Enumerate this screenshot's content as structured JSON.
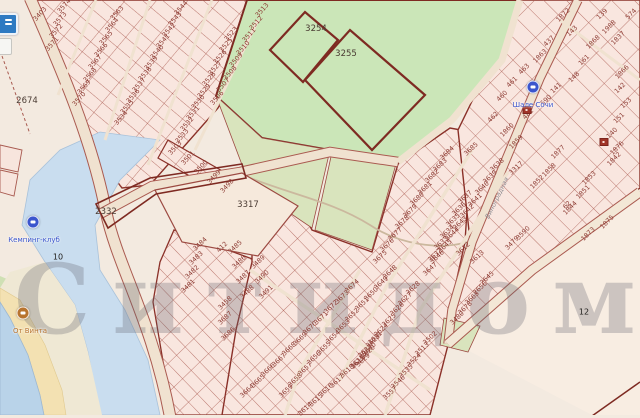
{
  "watermark": {
    "text": "Ситидом"
  },
  "street": {
    "name": "Виноградная",
    "x": 497,
    "y": 198,
    "rot": -64
  },
  "controls": {
    "buttons": [
      {
        "name": "map-layers-button",
        "color": "#2e7ac2"
      },
      {
        "name": "map-control-button",
        "color": "#f6f6f3"
      }
    ]
  },
  "pois": [
    {
      "kind": "lodging",
      "x": 533,
      "y": 87,
      "label": "Шале Сочи",
      "lx": 533,
      "ly": 96,
      "color": "#3b55cd"
    },
    {
      "kind": "club",
      "x": 33,
      "y": 222,
      "label": "Кемпинг-клуб",
      "lx": 34,
      "ly": 231,
      "color": "#3b55cd"
    },
    {
      "kind": "cafe",
      "x": 23,
      "y": 313,
      "label": "От Винта",
      "lx": 30,
      "ly": 322,
      "color": "#b8742f"
    }
  ],
  "buildings": [
    {
      "x": 604,
      "y": 142
    },
    {
      "x": 527,
      "y": 110
    }
  ],
  "area_labels": [
    {
      "t": "2674",
      "x": 27,
      "y": 101
    },
    {
      "t": "2332",
      "x": 106,
      "y": 212
    },
    {
      "t": "3317",
      "x": 248,
      "y": 205
    },
    {
      "t": "3254",
      "x": 316,
      "y": 29
    },
    {
      "t": "3255",
      "x": 346,
      "y": 54
    }
  ],
  "small_labels": [
    {
      "t": "10",
      "x": 58,
      "y": 257
    },
    {
      "t": "12",
      "x": 584,
      "y": 312
    }
  ],
  "parcel_blocks": [
    {
      "rot": -48,
      "start": [
        64,
        6
      ],
      "step": [
        -4,
        12.5
      ],
      "nums": [
        "3574",
        "3573",
        "3572",
        "3571"
      ]
    },
    {
      "rot": -48,
      "start": [
        117,
        13
      ],
      "step": [
        -5.5,
        12.3
      ],
      "nums": [
        "3563",
        "3564",
        "3565",
        "3566",
        "3567",
        "3568",
        "3569",
        "3570"
      ]
    },
    {
      "rot": -48,
      "start": [
        181,
        8
      ],
      "step": [
        -6,
        11
      ],
      "nums": [
        "3544",
        "3543",
        "3542",
        "3541",
        "3540",
        "3539",
        "3538",
        "3537",
        "3536",
        "3535",
        "3534"
      ]
    },
    {
      "rot": -48,
      "start": [
        231,
        34
      ],
      "step": [
        -5.5,
        11.3
      ],
      "nums": [
        "3523",
        "3525",
        "3526",
        "3527",
        "3528",
        "3529",
        "3530",
        "3531",
        "3532",
        "3533"
      ]
    },
    {
      "rot": -48,
      "start": [
        262,
        10
      ],
      "step": [
        -6.5,
        12.5
      ],
      "nums": [
        "3513",
        "3512",
        "3511",
        "3510",
        "3509",
        "3508",
        "3507",
        "3506"
      ]
    },
    {
      "rot": -47,
      "start": [
        175,
        148
      ],
      "step": [
        13,
        9.5
      ],
      "nums": [
        "3503",
        "3501",
        "3500",
        "3499",
        "3498"
      ]
    },
    {
      "rot": -44,
      "start": [
        200,
        244
      ],
      "step": [
        -4,
        14
      ],
      "nums": [
        "3484",
        "3483",
        "3482",
        "3481"
      ]
    },
    {
      "rot": -44,
      "start": [
        235,
        247
      ],
      "step": [
        4,
        15
      ],
      "nums": [
        "3485",
        "3486",
        "3487",
        "3488"
      ]
    },
    {
      "rot": -44,
      "start": [
        258,
        262
      ],
      "step": [
        4,
        15
      ],
      "nums": [
        "3489",
        "3490",
        "3491"
      ]
    },
    {
      "rot": -44,
      "start": [
        225,
        318
      ],
      "step": [
        3,
        16
      ],
      "nums": [
        "3687",
        "3686"
      ]
    },
    {
      "rot": -43,
      "start": [
        447,
        153
      ],
      "step": [
        -7.5,
        11.5
      ],
      "nums": [
        "3684",
        "3683",
        "3682",
        "3681",
        "3680",
        "3679",
        "3678",
        "3677",
        "3676",
        "3675"
      ]
    },
    {
      "rot": -43,
      "start": [
        497,
        165
      ],
      "step": [
        -7.5,
        11.5
      ],
      "nums": [
        "3638",
        "3639",
        "3640",
        "3641",
        "3642",
        "3643",
        "3644",
        "3645",
        "3646",
        "3647"
      ]
    },
    {
      "rot": -43,
      "start": [
        352,
        286
      ],
      "step": [
        -10.5,
        10.5
      ],
      "nums": [
        "3674",
        "3673",
        "3672",
        "3671",
        "3670",
        "3669",
        "3668",
        "3667",
        "3666",
        "3665",
        "3664"
      ]
    },
    {
      "rot": -43,
      "start": [
        390,
        272
      ],
      "step": [
        -9.5,
        10.8
      ],
      "nums": [
        "3648",
        "3649",
        "3650",
        "3651",
        "3652",
        "3653",
        "3654",
        "3655",
        "3656",
        "3657",
        "3658",
        "3659"
      ]
    },
    {
      "rot": -43,
      "start": [
        368,
        352
      ],
      "step": [
        -10.5,
        9.5
      ],
      "nums": [
        "3620",
        "3619",
        "3618",
        "3617",
        "3616",
        "3615",
        "3614"
      ]
    },
    {
      "rot": -43,
      "start": [
        430,
        338
      ],
      "step": [
        -8,
        11
      ],
      "nums": [
        "3502",
        "3513",
        "3524",
        "3535",
        "3546",
        "3557"
      ]
    },
    {
      "rot": -43,
      "start": [
        465,
        197
      ],
      "step": [
        -6,
        11.5
      ],
      "nums": [
        "3637",
        "3636",
        "3635",
        "3634",
        "3633",
        "3632"
      ]
    },
    {
      "rot": -43,
      "start": [
        413,
        288
      ],
      "step": [
        -8,
        10.5
      ],
      "nums": [
        "3628",
        "3627",
        "3626",
        "3625",
        "3624",
        "3623",
        "3622",
        "3621"
      ]
    },
    {
      "rot": -43,
      "start": [
        375,
        338
      ],
      "step": [
        -6,
        11
      ],
      "nums": [
        "3631",
        "3630",
        "3629"
      ]
    },
    {
      "rot": -43,
      "start": [
        487,
        278
      ],
      "step": [
        -7.5,
        10
      ],
      "nums": [
        "2645",
        "2656",
        "3663",
        "3678",
        "3480"
      ]
    }
  ],
  "parcel_singles": [
    {
      "t": "3403",
      "x": 40,
      "y": 14,
      "rot": -48
    },
    {
      "t": "412",
      "x": 222,
      "y": 247,
      "rot": -44
    },
    {
      "t": "3458",
      "x": 225,
      "y": 303,
      "rot": -44
    },
    {
      "t": "3685",
      "x": 471,
      "y": 149,
      "rot": -43
    },
    {
      "t": "3317",
      "x": 516,
      "y": 168,
      "rot": -43
    },
    {
      "t": "3612",
      "x": 463,
      "y": 249,
      "rot": -43
    },
    {
      "t": "3613",
      "x": 477,
      "y": 257,
      "rot": -43
    },
    {
      "t": "3590",
      "x": 523,
      "y": 233,
      "rot": -45
    },
    {
      "t": "3479",
      "x": 512,
      "y": 243,
      "rot": -45
    },
    {
      "t": "62",
      "x": 567,
      "y": 205,
      "rot": -45
    },
    {
      "t": "1872",
      "x": 563,
      "y": 15,
      "rot": -45
    },
    {
      "t": "143",
      "x": 572,
      "y": 31,
      "rot": -45
    },
    {
      "t": "139",
      "x": 602,
      "y": 14,
      "rot": -45
    },
    {
      "t": "1988",
      "x": 609,
      "y": 27,
      "rot": -45
    },
    {
      "t": "574",
      "x": 631,
      "y": 14,
      "rot": -45
    },
    {
      "t": "1837",
      "x": 618,
      "y": 38,
      "rot": -45
    },
    {
      "t": "1868",
      "x": 593,
      "y": 42,
      "rot": -45
    },
    {
      "t": "437",
      "x": 549,
      "y": 41,
      "rot": -45
    },
    {
      "t": "1863",
      "x": 540,
      "y": 56,
      "rot": -45
    },
    {
      "t": "161",
      "x": 584,
      "y": 60,
      "rot": -45
    },
    {
      "t": "1866",
      "x": 622,
      "y": 72,
      "rot": -45
    },
    {
      "t": "148",
      "x": 574,
      "y": 77,
      "rot": -45
    },
    {
      "t": "141",
      "x": 556,
      "y": 88,
      "rot": -45
    },
    {
      "t": "142",
      "x": 620,
      "y": 88,
      "rot": -45
    },
    {
      "t": "463",
      "x": 524,
      "y": 69,
      "rot": -45
    },
    {
      "t": "461",
      "x": 512,
      "y": 82,
      "rot": -45
    },
    {
      "t": "460",
      "x": 502,
      "y": 96,
      "rot": -45
    },
    {
      "t": "462",
      "x": 493,
      "y": 117,
      "rot": -45
    },
    {
      "t": "481",
      "x": 528,
      "y": 114,
      "rot": -45
    },
    {
      "t": "590",
      "x": 546,
      "y": 100,
      "rot": -45
    },
    {
      "t": "153",
      "x": 626,
      "y": 103,
      "rot": -45
    },
    {
      "t": "151",
      "x": 619,
      "y": 118,
      "rot": -45
    },
    {
      "t": "140",
      "x": 612,
      "y": 133,
      "rot": -45
    },
    {
      "t": "1860",
      "x": 507,
      "y": 130,
      "rot": -45
    },
    {
      "t": "1859",
      "x": 516,
      "y": 142,
      "rot": -45
    },
    {
      "t": "1877",
      "x": 558,
      "y": 152,
      "rot": -45
    },
    {
      "t": "1858",
      "x": 549,
      "y": 170,
      "rot": -45
    },
    {
      "t": "1852",
      "x": 537,
      "y": 182,
      "rot": -45
    },
    {
      "t": "1853",
      "x": 589,
      "y": 178,
      "rot": -45
    },
    {
      "t": "1851",
      "x": 583,
      "y": 192,
      "rot": -45
    },
    {
      "t": "1842",
      "x": 614,
      "y": 159,
      "rot": -45
    },
    {
      "t": "1844",
      "x": 570,
      "y": 208,
      "rot": -45
    },
    {
      "t": "1875",
      "x": 607,
      "y": 222,
      "rot": -45
    },
    {
      "t": "1873",
      "x": 588,
      "y": 234,
      "rot": -45
    },
    {
      "t": "1876",
      "x": 617,
      "y": 148,
      "rot": -45
    }
  ]
}
